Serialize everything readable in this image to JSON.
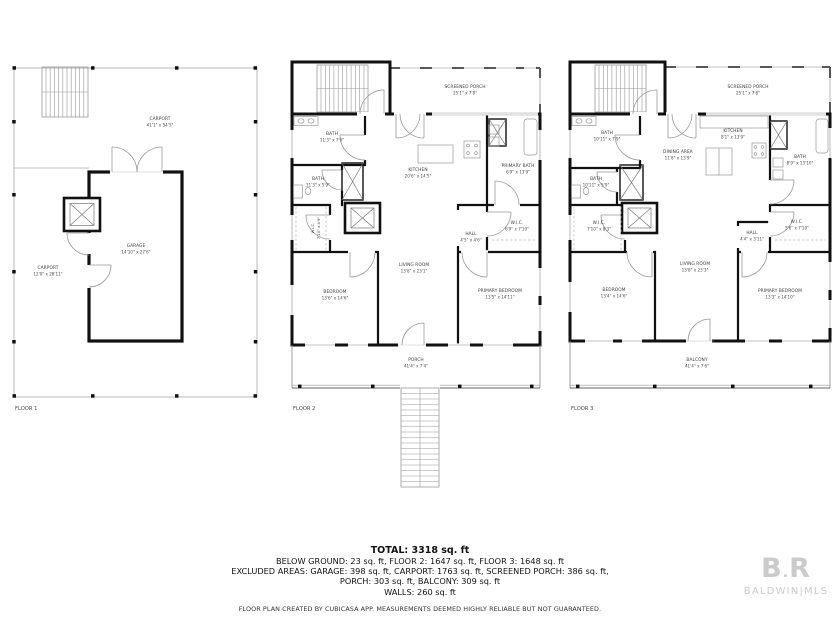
{
  "floors": {
    "floor1": {
      "label": "FLOOR 1",
      "rooms": {
        "carport_top": {
          "name": "CARPORT",
          "dims": "41'1\" x 54'5\""
        },
        "garage": {
          "name": "GARAGE",
          "dims": "14'10\" x 27'6\""
        },
        "carport_left": {
          "name": "CARPORT",
          "dims": "12'0\" x 28'11\""
        }
      }
    },
    "floor2": {
      "label": "FLOOR 2",
      "rooms": {
        "screened_porch": {
          "name": "SCREENED PORCH",
          "dims": "25'1\" x 7'8\""
        },
        "bath1": {
          "name": "BATH",
          "dims": "11'3\" x 7'9\""
        },
        "bath2": {
          "name": "BATH",
          "dims": "11'3\" x 5'9\""
        },
        "wic_left": {
          "name": "W.I.C.",
          "dims": "7'10\" x 4'9\""
        },
        "kitchen": {
          "name": "KITCHEN",
          "dims": "20'6\" x 14'5\""
        },
        "primary_bath": {
          "name": "PRIMARY BATH",
          "dims": "6'9\" x 13'9\""
        },
        "wic_right": {
          "name": "W.I.C.",
          "dims": "6'9\" x 7'10\""
        },
        "hall": {
          "name": "HALL",
          "dims": "4'5\" x 4'6\""
        },
        "living_room": {
          "name": "LIVING ROOM",
          "dims": "13'8\" x 23'1\""
        },
        "bedroom": {
          "name": "BEDROOM",
          "dims": "13'6\" x 14'6\""
        },
        "primary_bedroom": {
          "name": "PRIMARY BEDROOM",
          "dims": "13'5\" x 14'11\""
        },
        "porch": {
          "name": "PORCH",
          "dims": "41'4\" x 7'4\""
        }
      }
    },
    "floor3": {
      "label": "FLOOR 3",
      "rooms": {
        "screened_porch": {
          "name": "SCREENED PORCH",
          "dims": "25'1\" x 7'8\""
        },
        "bath1": {
          "name": "BATH",
          "dims": "10'11\" x 7'9\""
        },
        "bath2": {
          "name": "BATH",
          "dims": "10'11\" x 5'9\""
        },
        "wic_left": {
          "name": "W.I.C.",
          "dims": "7'10\" x 8'3\""
        },
        "dining": {
          "name": "DINING AREA",
          "dims": "11'8\" x 13'9\""
        },
        "kitchen": {
          "name": "KITCHEN",
          "dims": "8'1\" x 13'9\""
        },
        "bath3": {
          "name": "BATH",
          "dims": "8'9\" x 13'10\""
        },
        "wic_right": {
          "name": "W.I.C.",
          "dims": "5'6\" x 7'10\""
        },
        "hall": {
          "name": "HALL",
          "dims": "4'4\" x 3'11\""
        },
        "living_room": {
          "name": "LIVING ROOM",
          "dims": "13'8\" x 23'3\""
        },
        "bedroom": {
          "name": "BEDROOM",
          "dims": "13'4\" x 14'6\""
        },
        "primary_bedroom": {
          "name": "PRIMARY BEDROOM",
          "dims": "13'3\" x 14'10\""
        },
        "balcony": {
          "name": "BALCONY",
          "dims": "41'4\" x 7'6\""
        }
      }
    }
  },
  "summary": {
    "total": "TOTAL: 3318 sq. ft",
    "line1": "BELOW GROUND: 23 sq. ft, FLOOR 2: 1647 sq. ft, FLOOR 3: 1648 sq. ft",
    "line2": "EXCLUDED AREAS: GARAGE: 398 sq. ft, CARPORT: 1763 sq. ft, SCREENED PORCH: 386 sq. ft,",
    "line3": "PORCH: 303 sq. ft, BALCONY: 309 sq. ft",
    "line4": "WALLS: 260 sq. ft",
    "disclaimer": "FLOOR PLAN CREATED BY CUBICASA APP. MEASUREMENTS DEEMED HIGHLY RELIABLE BUT NOT GUARANTEED."
  },
  "logo": {
    "letter_b": "B",
    "dot": ".",
    "letter_r": "R",
    "wordmark": "BALDWIN|MLS"
  },
  "colors": {
    "wall": "#111111",
    "thin_line": "#9a9a9a",
    "logo_gray": "#cbcbcb"
  }
}
